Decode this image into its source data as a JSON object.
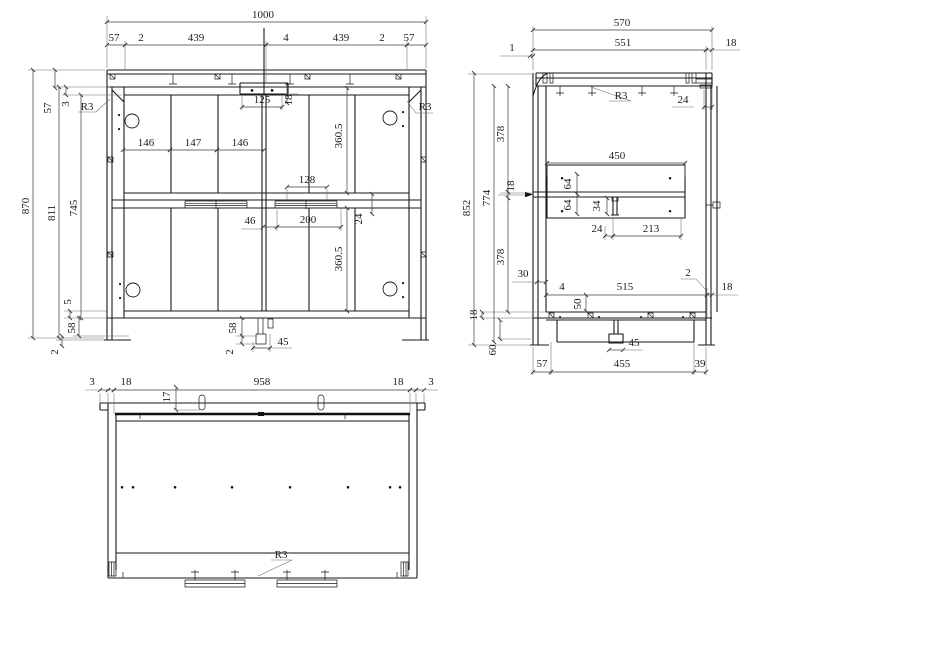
{
  "style": {
    "bg": "#ffffff",
    "object_line": "#1a1a1a",
    "dim_line": "#3d3d3d"
  },
  "drawing": {
    "front": {
      "total_width": "1000",
      "segments": [
        "57",
        "2",
        "439",
        "4",
        "439",
        "2",
        "57"
      ],
      "rail_h": "57",
      "gap3": "3",
      "r3_left": "R3",
      "r3_right": "R3",
      "h870": "870",
      "h811": "811",
      "h745": "745",
      "b5": "5",
      "b58": "58",
      "b2": "2",
      "plate_w": "125",
      "plate_h": "18",
      "dividers": [
        "146",
        "147",
        "146"
      ],
      "s128": "128",
      "s46": "46",
      "s200": "200",
      "s24": "24",
      "panel_upper": "360.5",
      "panel_lower": "360.5",
      "f58": "58",
      "f2": "2",
      "f45": "45"
    },
    "side": {
      "total_w": "570",
      "inner_w": "551",
      "off1": "1",
      "off18": "18",
      "r3": "R3",
      "t24_top": "24",
      "h852": "852",
      "h774": "774",
      "p378a": "378",
      "t18_shelf": "18",
      "p378b": "378",
      "t30": "30",
      "t18_base": "18",
      "t60": "60",
      "shelf_w": "450",
      "t64a": "64",
      "t64b": "64",
      "t34": "34",
      "t24": "24",
      "t213": "213",
      "b4": "4",
      "b515": "515",
      "b2": "2",
      "b18": "18",
      "b50": "50",
      "b45": "45",
      "b57": "57",
      "b455": "455",
      "b39": "39"
    },
    "top": {
      "e3l": "3",
      "e18l": "18",
      "w958": "958",
      "e18r": "18",
      "e3r": "3",
      "t17": "17",
      "r3": "R3"
    }
  }
}
